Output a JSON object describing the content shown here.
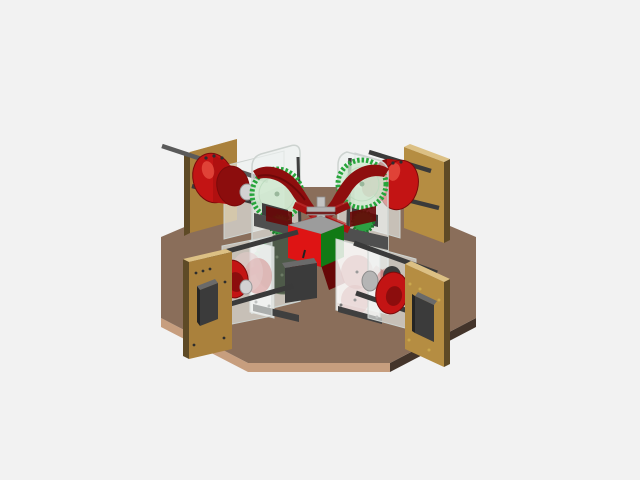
{
  "scene": {
    "view": "isometric-cad-render",
    "background": "#f2f2f2",
    "parts": [
      "octagonal wooden base plate",
      "corner mounting panel x4",
      "servo motor x4",
      "red cable spool x4",
      "steel guide rod x8",
      "acrylic gear tower x2",
      "green drive gear x4",
      "dark drive disc",
      "red drive belts",
      "center carriage cube",
      "gray cross mount"
    ]
  },
  "colors": {
    "bg": "#f2f2f2",
    "base_top": "#8a6e5a",
    "base_edge_light": "#c79e7e",
    "base_edge_dark": "#43342a",
    "panel_face": "#aa813c",
    "panel_face_alt": "#b58d42",
    "panel_side_dark": "#5e4a26",
    "panel_top_light": "#dcc084",
    "servo_front": "#3b3b3b",
    "servo_top": "#6a6a6a",
    "servo_side": "#242424",
    "rod_dark": "#3a3a3a",
    "rod_mid": "#5a5a5a",
    "spool_red": "#c31414",
    "spool_red_dark": "#8c0d0d",
    "spool_red_deep": "#7a0a0a",
    "spool_red_light": "#ef5a4a",
    "spool_barrel": "#b01010",
    "hub_gray": "#d2d2d2",
    "hub_gray_dark": "#9a9a9a",
    "gray_cyl": "#b5b5b5",
    "gray_cyl_edge": "#8c8c8c",
    "acrylic": "rgba(237,242,240,0.62)",
    "acrylic_edge": "#cdd3d0",
    "plate_white": "rgba(250,248,248,0.85)",
    "plate_pink": "rgba(228,203,203,0.55)",
    "tint_red": "rgba(200,90,90,0.35)",
    "gear_teeth": "#27a53b",
    "gear_teeth_dark": "#1b7a2c",
    "gear_face": "#cfe9cf",
    "gear_ring": "#b9d9bb",
    "gear_center": "#9ab89c",
    "gear_small": "#2da043",
    "disc_dark": "#4e5a49",
    "disc_rim": "#68775f",
    "disc_dot": "#6d7c66",
    "bracket": "#4f4f4f",
    "bracket_dark": "#3f3f3f",
    "belt": "#8e0e0e",
    "belt_dark": "#670707",
    "belt_bright": "#a81212",
    "belt_hi": "#c43030",
    "cube_red": "#de1414",
    "cube_green": "#117a15",
    "cube_top": "#9c9c9c",
    "cube_edge": "#888888",
    "cross_light": "#c4c4c4",
    "cross_mid": "#b2b2b2",
    "cross_edge": "#8f8f8f",
    "screw_gold": "#caa84e",
    "screw_dark": "#2e2e2e",
    "plate_screw": "#777777",
    "cable": "#222222"
  }
}
